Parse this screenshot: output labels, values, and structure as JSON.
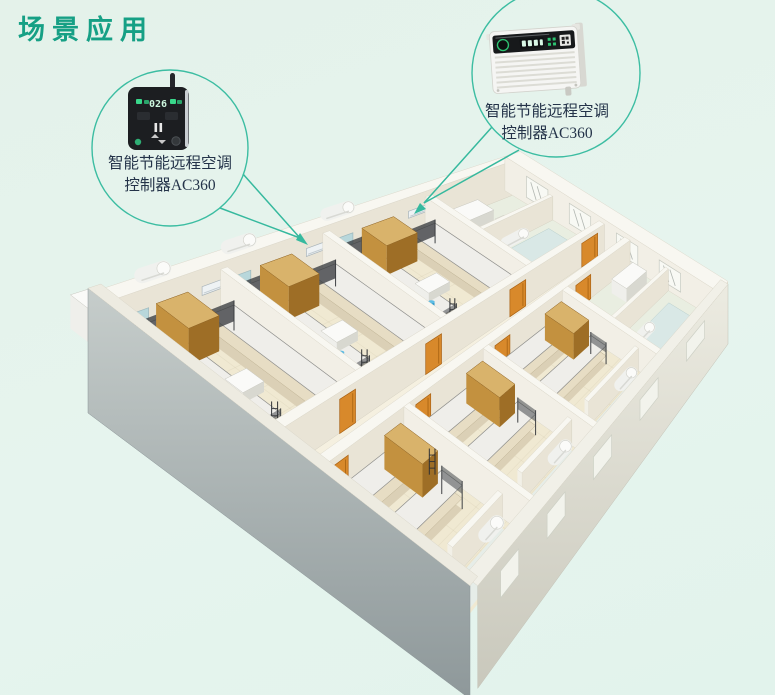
{
  "page": {
    "title": "场景应用",
    "background": "#e5f2eb"
  },
  "accent": {
    "teal": "#36b99e",
    "title_color": "#16a085",
    "label_color": "#243349"
  },
  "callout_left": {
    "label_line1": "智能节能远程空调",
    "label_line2": "控制器AC360",
    "device_icon": "smart-thermostat-panel",
    "display_value": "026"
  },
  "callout_right": {
    "label_line1": "智能节能远程空调",
    "label_line2": "控制器AC360",
    "device_icon": "ac-remote-controller-box"
  },
  "illustration": {
    "icon": "dormitory-isometric-floorplan"
  }
}
